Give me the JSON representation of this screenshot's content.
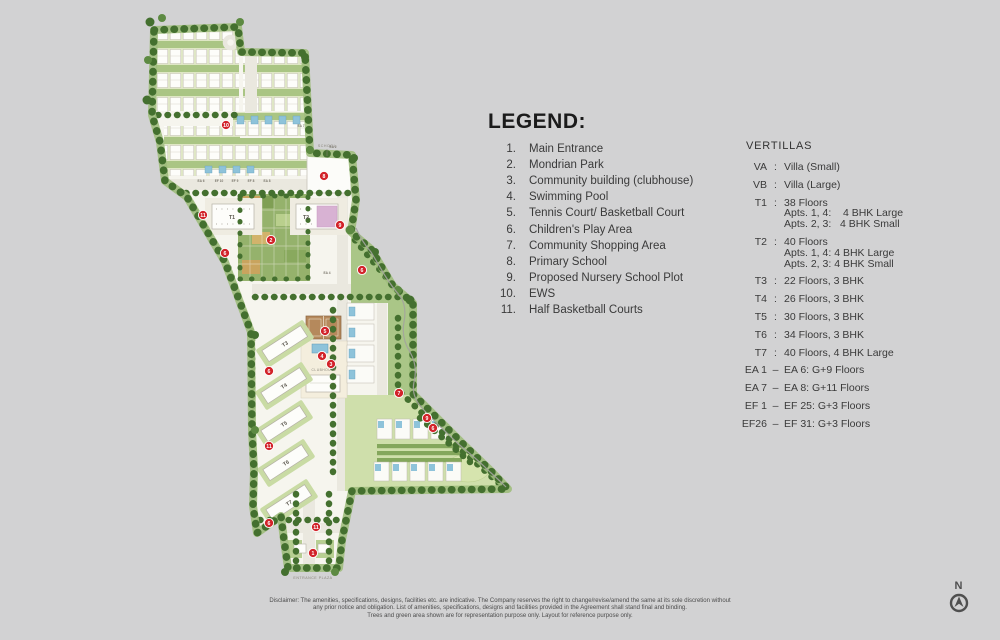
{
  "page": {
    "background": "#d2d2d3"
  },
  "legend": {
    "title": "LEGEND:",
    "items": [
      {
        "num": "1.",
        "label": "Main Entrance"
      },
      {
        "num": "2.",
        "label": "Mondrian Park"
      },
      {
        "num": "3.",
        "label": "Community building (clubhouse)"
      },
      {
        "num": "4.",
        "label": "Swimming Pool"
      },
      {
        "num": "5.",
        "label": "Tennis Court/ Basketball Court"
      },
      {
        "num": "6.",
        "label": "Children's Play Area"
      },
      {
        "num": "7.",
        "label": "Community Shopping Area"
      },
      {
        "num": "8.",
        "label": "Primary School"
      },
      {
        "num": "9.",
        "label": "Proposed Nursery School Plot"
      },
      {
        "num": "10.",
        "label": "EWS"
      },
      {
        "num": "11.",
        "label": "Half Basketball Courts"
      }
    ]
  },
  "vertillas": {
    "title": "VERTILLAS",
    "rows": [
      {
        "code": "VA",
        "sep": ":",
        "lines": [
          "Villa (Small)"
        ]
      },
      {
        "code": "VB",
        "sep": ":",
        "lines": [
          "Villa (Large)"
        ]
      },
      {
        "code": "T1",
        "sep": ":",
        "lines": [
          "38 Floors",
          "Apts. 1, 4:    4 BHK Large",
          "Apts. 2, 3:   4 BHK Small"
        ]
      },
      {
        "code": "T2",
        "sep": ":",
        "lines": [
          "40 Floors",
          "Apts. 1, 4: 4 BHK Large",
          "Apts. 2, 3: 4 BHK Small"
        ]
      },
      {
        "code": "T3",
        "sep": ":",
        "lines": [
          "22 Floors, 3 BHK"
        ]
      },
      {
        "code": "T4",
        "sep": ":",
        "lines": [
          "26 Floors, 3 BHK"
        ]
      },
      {
        "code": "T5",
        "sep": ":",
        "lines": [
          "30 Floors, 3 BHK"
        ]
      },
      {
        "code": "T6",
        "sep": ":",
        "lines": [
          "34 Floors, 3 BHK"
        ]
      },
      {
        "code": "T7",
        "sep": ":",
        "lines": [
          "40 Floors, 4 BHK Large"
        ]
      },
      {
        "code": "EA 1",
        "sep": "–",
        "lines": [
          "EA 6: G+9 Floors"
        ]
      },
      {
        "code": "EA 7",
        "sep": "–",
        "lines": [
          "EA 8: G+11 Floors"
        ]
      },
      {
        "code": "EF 1",
        "sep": "–",
        "lines": [
          "EF 25: G+3 Floors"
        ]
      },
      {
        "code": "EF26",
        "sep": "–",
        "lines": [
          "EF 31: G+3 Floors"
        ]
      }
    ]
  },
  "map": {
    "colors": {
      "marker": "#d2232a",
      "pool": "#8ec3da",
      "court": "#b5895c",
      "accent_pink": "#d8b2d3",
      "tree_dark": "#44702f",
      "tree_light": "#5d8a42"
    },
    "markers": [
      {
        "n": "10",
        "x": 226,
        "y": 125
      },
      {
        "n": "8",
        "x": 324,
        "y": 176
      },
      {
        "n": "11",
        "x": 203,
        "y": 215
      },
      {
        "n": "9",
        "x": 340,
        "y": 225
      },
      {
        "n": "2",
        "x": 271,
        "y": 240
      },
      {
        "n": "6",
        "x": 225,
        "y": 253
      },
      {
        "n": "6",
        "x": 362,
        "y": 270
      },
      {
        "n": "5",
        "x": 325,
        "y": 331
      },
      {
        "n": "4",
        "x": 322,
        "y": 356
      },
      {
        "n": "3",
        "x": 331,
        "y": 364
      },
      {
        "n": "6",
        "x": 269,
        "y": 371
      },
      {
        "n": "7",
        "x": 399,
        "y": 393
      },
      {
        "n": "9",
        "x": 427,
        "y": 418
      },
      {
        "n": "6",
        "x": 433,
        "y": 428
      },
      {
        "n": "11",
        "x": 269,
        "y": 446
      },
      {
        "n": "6",
        "x": 269,
        "y": 523
      },
      {
        "n": "11",
        "x": 316,
        "y": 527
      },
      {
        "n": "1",
        "x": 313,
        "y": 553
      }
    ],
    "tower_labels": [
      {
        "t": "T1",
        "x": 232,
        "y": 217,
        "r": 0
      },
      {
        "t": "T2",
        "x": 306,
        "y": 217,
        "r": 0
      },
      {
        "t": "T3",
        "x": 285,
        "y": 344,
        "r": -33
      },
      {
        "t": "T4",
        "x": 284,
        "y": 386,
        "r": -33
      },
      {
        "t": "T5",
        "x": 284,
        "y": 424,
        "r": -33
      },
      {
        "t": "T6",
        "x": 286,
        "y": 463,
        "r": -33
      },
      {
        "t": "T7",
        "x": 289,
        "y": 503,
        "r": -33
      }
    ],
    "unit_labels": [
      {
        "t": "EA 6",
        "x": 201,
        "y": 182
      },
      {
        "t": "EF 10",
        "x": 219,
        "y": 182
      },
      {
        "t": "EF 9",
        "x": 235,
        "y": 182
      },
      {
        "t": "EF 8",
        "x": 251,
        "y": 182
      },
      {
        "t": "EA 8",
        "x": 267,
        "y": 182
      },
      {
        "t": "EA 7",
        "x": 301,
        "y": 127
      },
      {
        "t": "EA 2",
        "x": 333,
        "y": 148
      },
      {
        "t": "EA 4",
        "x": 327,
        "y": 274
      }
    ],
    "place_labels": [
      {
        "t": "SCHOOL",
        "x": 327,
        "y": 147,
        "s": 3.6
      },
      {
        "t": "CLUBHOUSE",
        "x": 324,
        "y": 371,
        "s": 3.3
      },
      {
        "t": "ENTRANCE PLAZA",
        "x": 313,
        "y": 579,
        "s": 3.6
      }
    ]
  },
  "north": {
    "label": "N"
  },
  "disclaimer": {
    "lines": [
      "Disclaimer:  The amenities, specifications, designs, facilities etc. are indicative. The Company reserves the right to  change/revise/amend the same at its sole discretion without",
      "any prior notice and obligation. List of amenities, specifications, designs and facilities provided in the Agreement shall stand final and binding.",
      "Trees and green area shown are for representation purpose only. Layout for reference purpose only."
    ]
  }
}
